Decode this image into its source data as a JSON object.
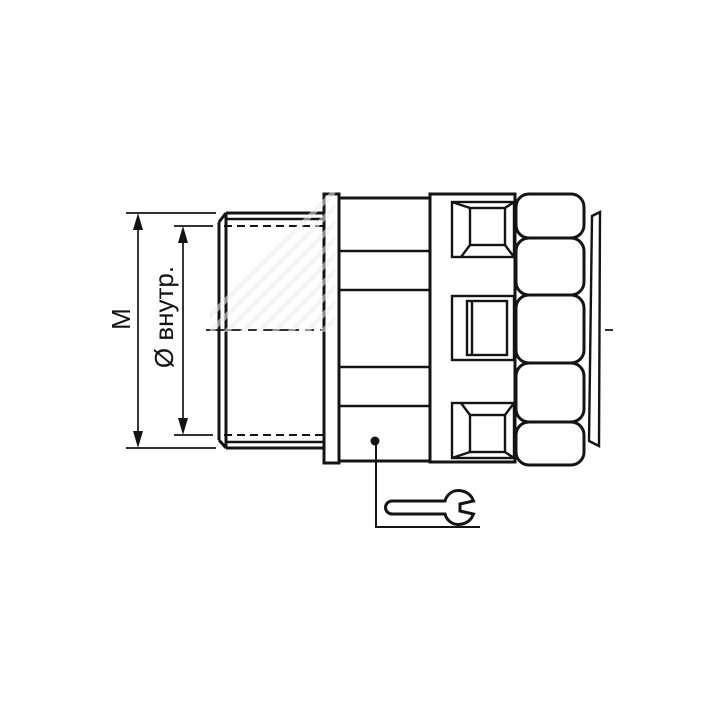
{
  "diagram": {
    "type": "technical-drawing",
    "subject": "cable-gland-fitting-side-view",
    "labels": {
      "dimension_m": "M",
      "dimension_inner_diameter": "Ø внутр."
    },
    "icons": {
      "wrench": "open-end-wrench",
      "leader_dot": "filled-dot",
      "centerline": "dash-dot-axis"
    },
    "colors": {
      "line": "#141414",
      "background": "#ffffff",
      "watermark": "#ececec"
    }
  }
}
